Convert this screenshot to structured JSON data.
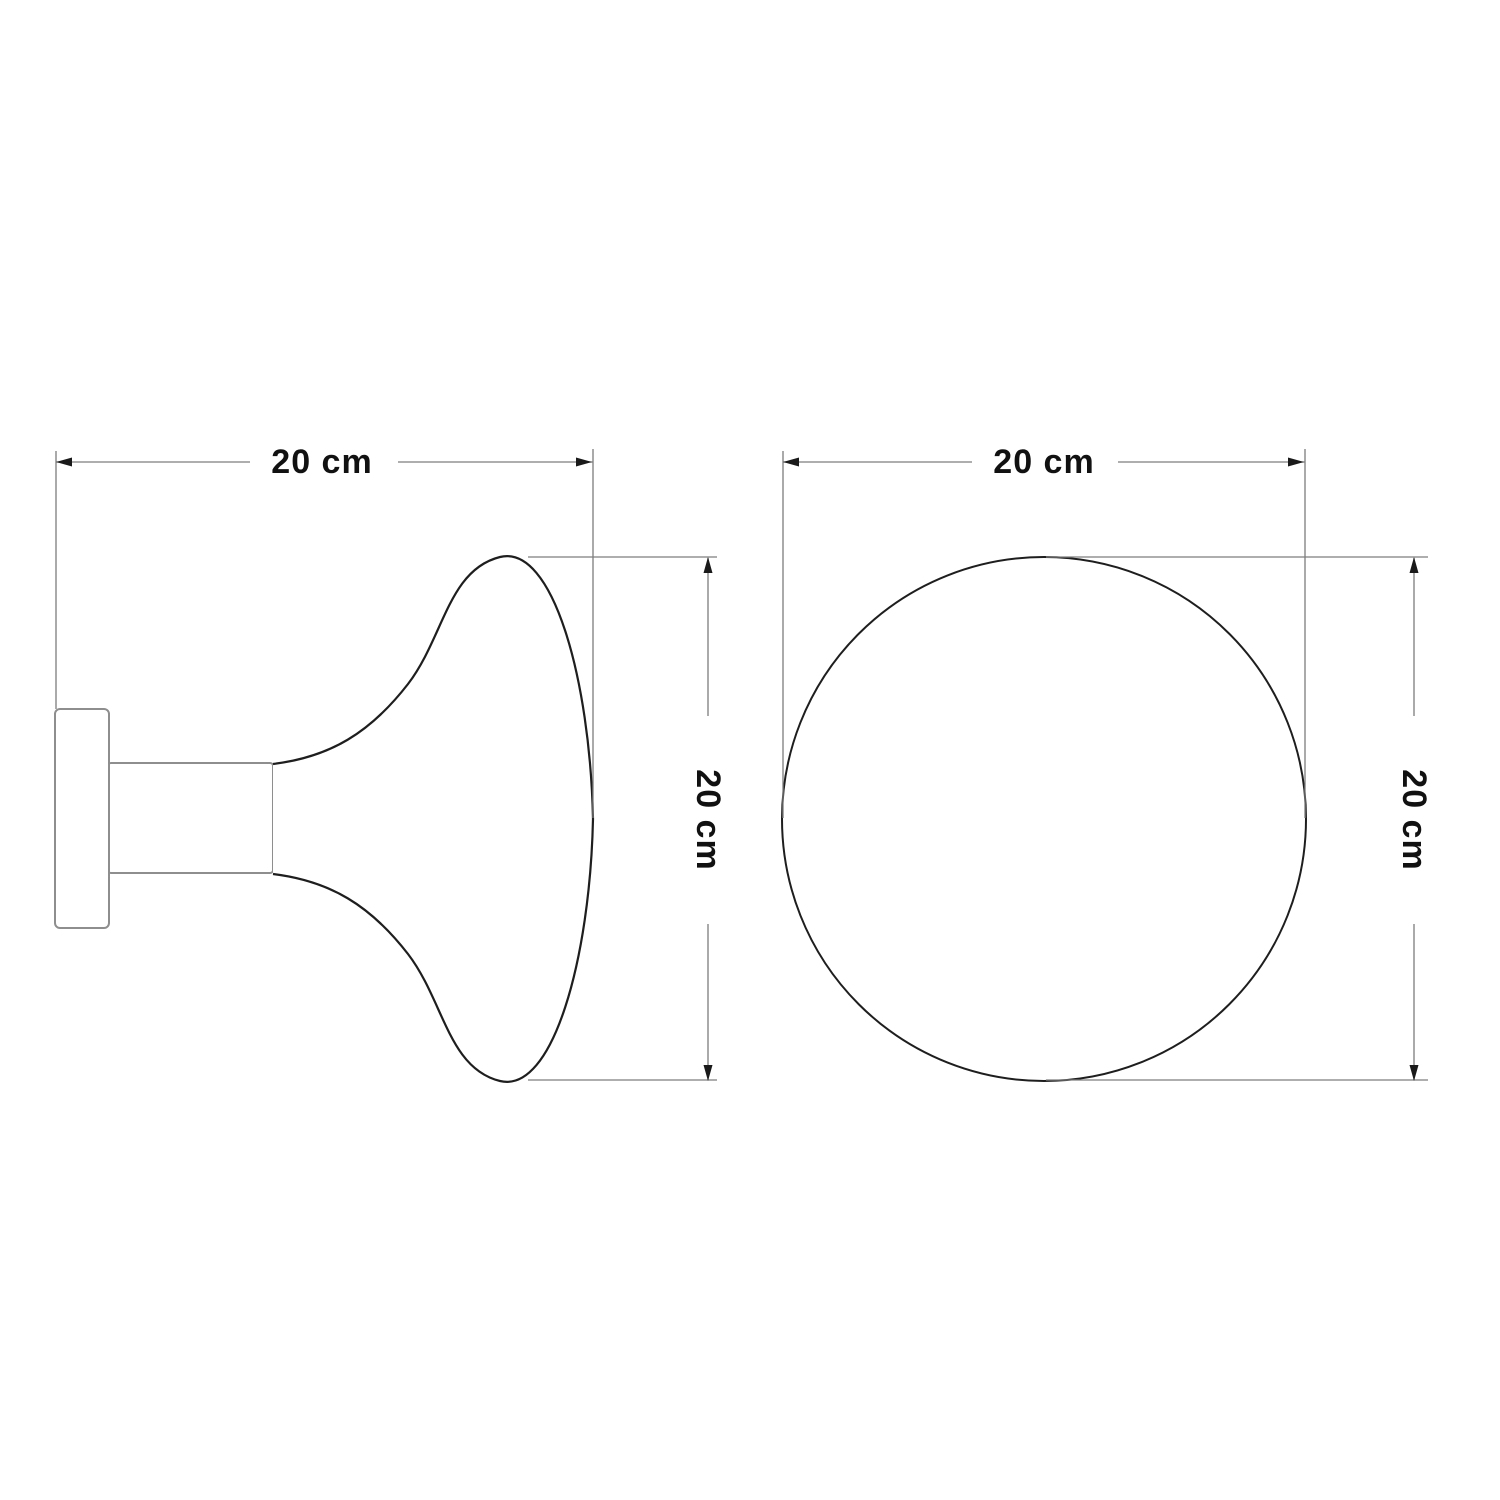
{
  "side_view": {
    "width_dimension": "20 cm",
    "height_dimension": "20 cm"
  },
  "front_view": {
    "width_dimension": "20 cm",
    "height_dimension": "20 cm"
  },
  "style": {
    "background": "#ffffff",
    "knob_outline": "#1e1e1e",
    "hardware_outline": "#8e8e8e",
    "dimension_line": "#7d7d7d",
    "text_color": "#111111"
  }
}
